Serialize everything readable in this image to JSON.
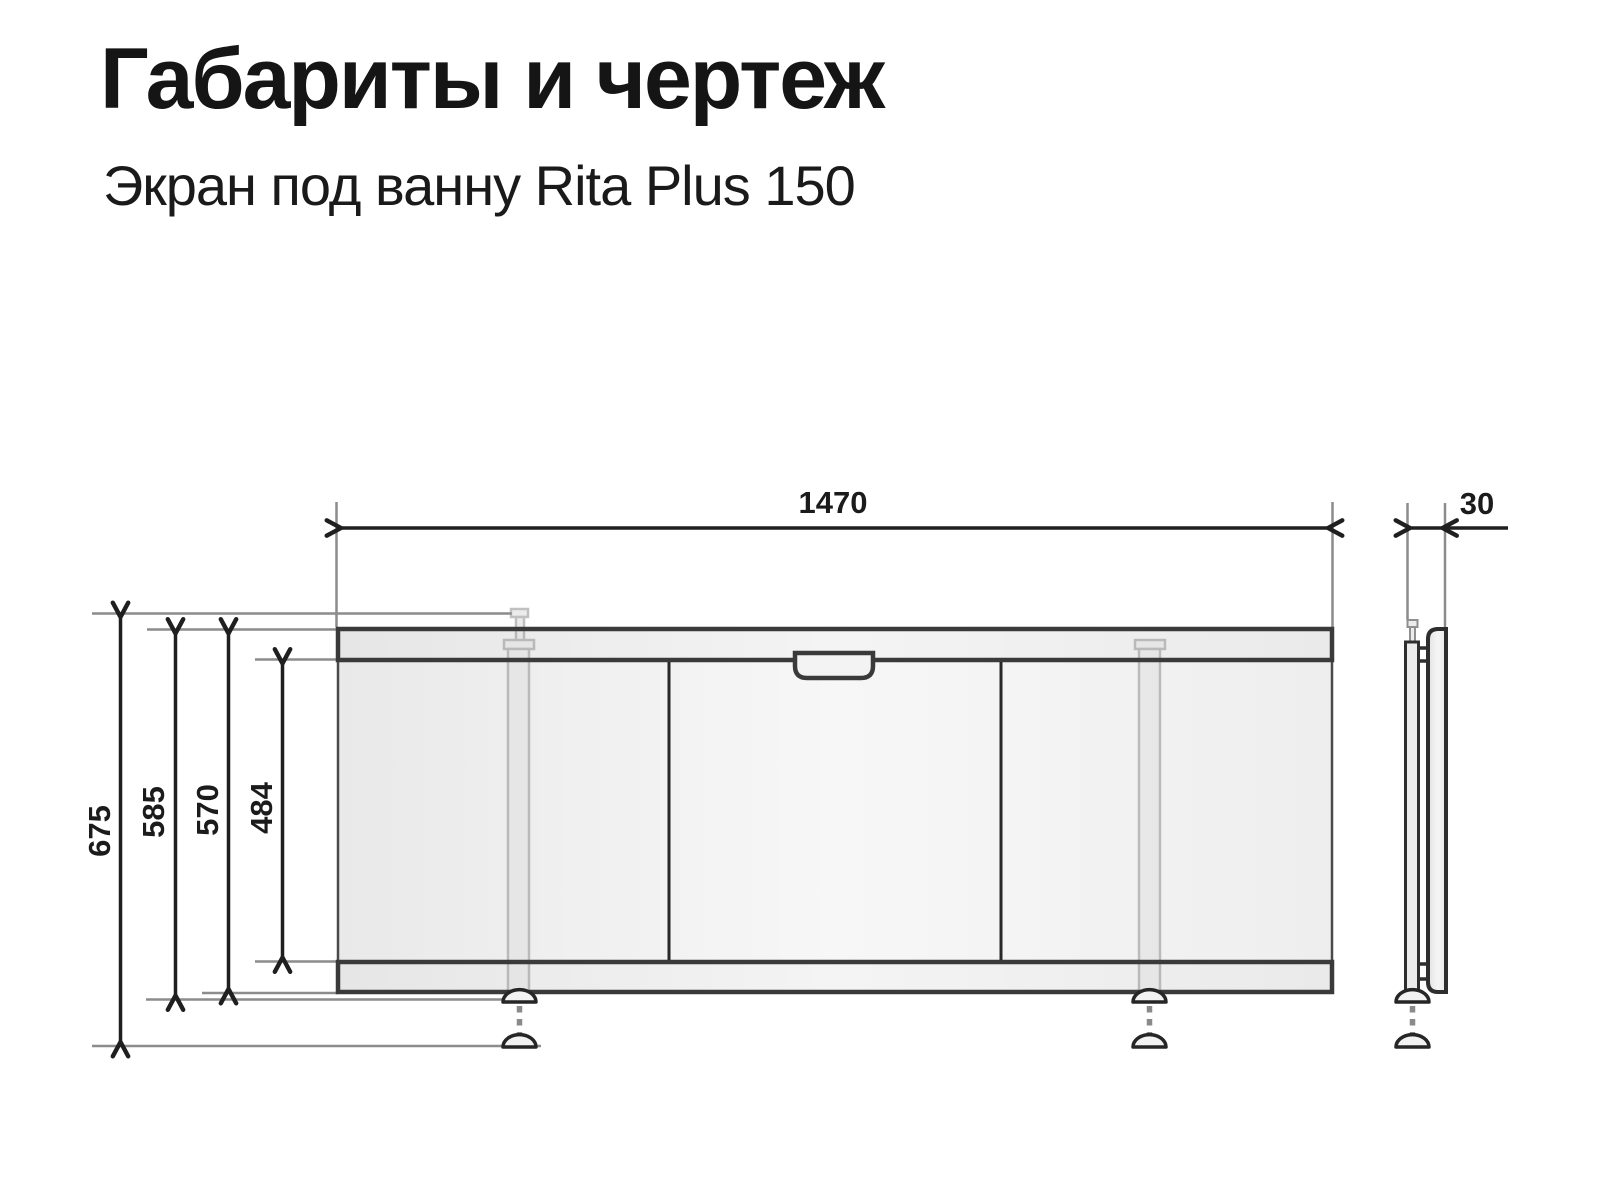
{
  "page": {
    "title": "Габариты и чертеж",
    "subtitle": "Экран под ванну Rita Plus 150"
  },
  "drawing": {
    "type": "technical-drawing",
    "labels": {
      "width_mm": "1470",
      "depth_mm": "30",
      "height_total_mm": "675",
      "height_to_foot_mm": "585",
      "height_panel_mm": "570",
      "height_inner_mm": "484"
    },
    "colors": {
      "outline_dark": "#3a3a3a",
      "dimension_line": "#1f1f1f",
      "extension_line": "#8c8c8c",
      "panel_fill": "#efefef"
    }
  }
}
